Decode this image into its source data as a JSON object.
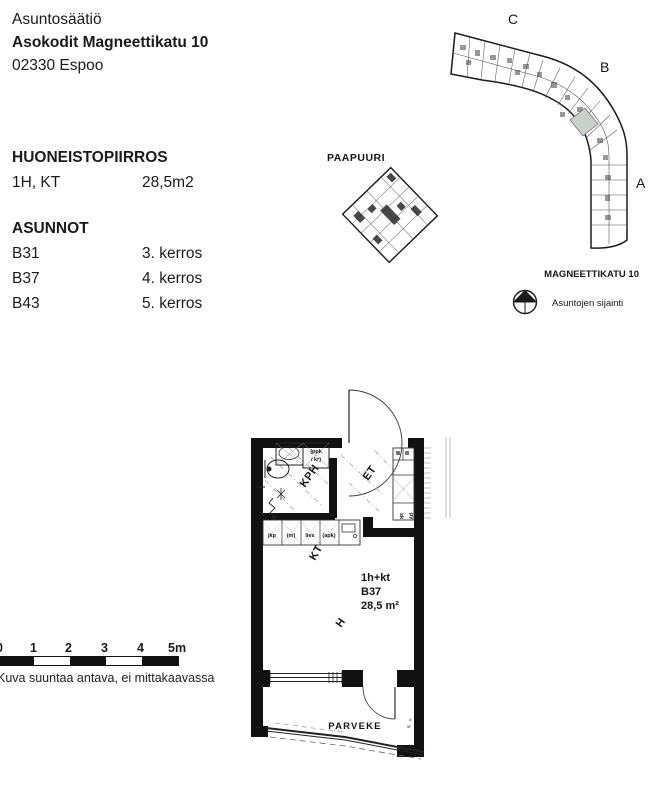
{
  "header": {
    "org": "Asuntosäätiö",
    "building": "Asokodit Magneettikatu 10",
    "city": "02330 Espoo"
  },
  "info": {
    "title": "HUONEISTOPIIRROS",
    "type": "1H, KT",
    "area": "28,5m2",
    "section": "ASUNNOT",
    "apartments": [
      {
        "id": "B31",
        "floor": "3. kerros"
      },
      {
        "id": "B37",
        "floor": "4. kerros"
      },
      {
        "id": "B43",
        "floor": "5. kerros"
      }
    ]
  },
  "siteplan": {
    "sections": {
      "c": "C",
      "b": "B",
      "a": "A"
    },
    "paapuuri": "PAAPUURI",
    "street": "MAGNEETTIKATU 10",
    "caption": "Asuntojen sijainti",
    "highlight_color": "#c8d0c9"
  },
  "floorplan": {
    "rooms": {
      "kph": "KPH",
      "et": "ET",
      "kt": "KT",
      "h": "H",
      "parveke": "PARVEKE"
    },
    "unit": {
      "type": "1h+kt",
      "id": "B37",
      "area": "28,5 m²"
    },
    "fixtures": {
      "ppk1": "(ppk",
      "ppk2": "/ kr)",
      "jkp": "jkp",
      "m": "(m)",
      "lies": "lies",
      "apk": "(apk)",
      "sk": "sk",
      "py": "py",
      "o": "o",
      "vr": "vr"
    }
  },
  "scalebar": {
    "ticks": [
      "0",
      "1",
      "2",
      "3",
      "4",
      "5m"
    ],
    "caption": "Kuva suuntaa antava, ei mittakaavassa"
  }
}
